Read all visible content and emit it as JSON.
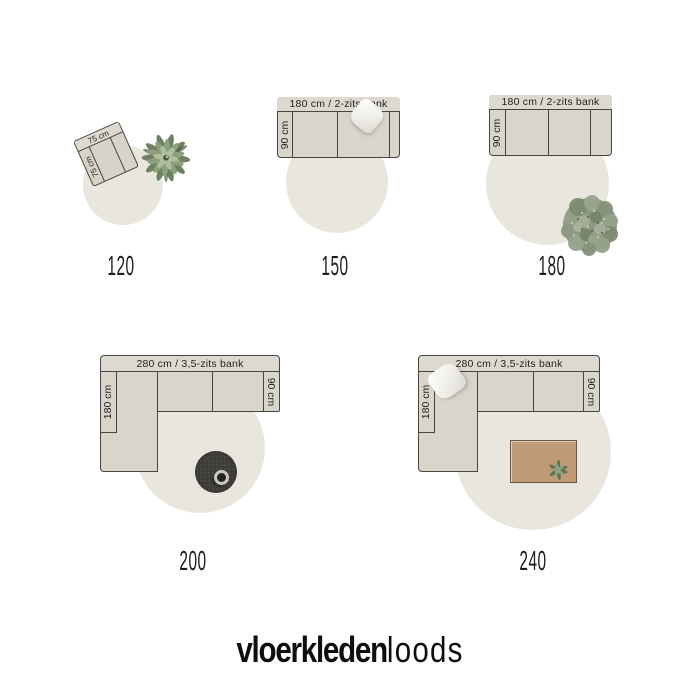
{
  "diagrams": [
    {
      "size": "120",
      "chair": {
        "width_label": "75 cm",
        "depth_label": "75 cm"
      }
    },
    {
      "size": "150",
      "sofa": {
        "top_label": "180 cm / 2-zits bank",
        "depth_label": "90 cm"
      }
    },
    {
      "size": "180",
      "sofa": {
        "top_label": "180 cm / 2-zits bank",
        "depth_label": "90 cm"
      }
    },
    {
      "size": "200",
      "sofa": {
        "top_label": "280 cm / 3,5-zits bank",
        "chaise_label": "180 cm",
        "depth_label": "90 cm"
      }
    },
    {
      "size": "240",
      "sofa": {
        "top_label": "280 cm / 3,5-zits bank",
        "chaise_label": "180 cm",
        "depth_label": "90 cm"
      }
    }
  ],
  "logo": {
    "bold": "vloerkleden",
    "light": "loods"
  },
  "colors": {
    "background": "#ffffff",
    "rug": "#e9e6de",
    "sofa_fill": "#d9d5cb",
    "outline": "#46453f",
    "pouf": "#403e3a",
    "coffee_table": "#c09a76",
    "plant_green": "#8da07e",
    "text": "#1d1c1a"
  }
}
